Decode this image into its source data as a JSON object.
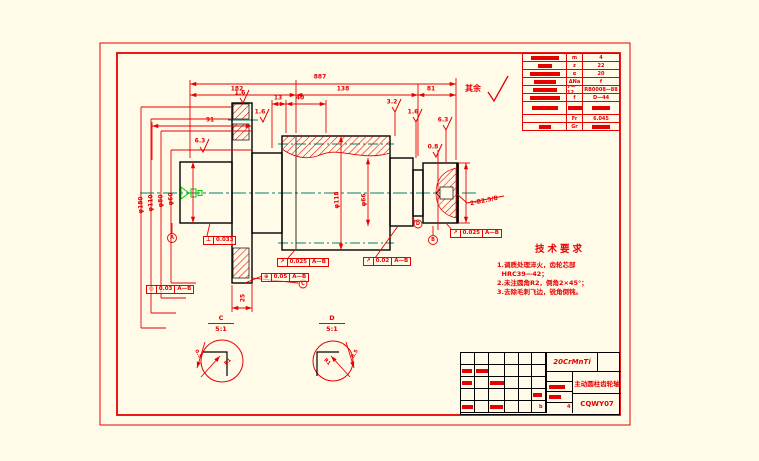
{
  "colors": {
    "background": "#FFFBE8",
    "line_red": "#E60000",
    "line_black": "#000000",
    "centerline_green": "#00806A",
    "symbol_green": "#00CC00"
  },
  "surface_note": {
    "label": "其余"
  },
  "tech_req": {
    "title": "技术要求",
    "lines": [
      "1.调质处理淬火，齿轮芯部",
      "  HRC39—42；",
      "2.未注圆角R2，倒角2×45°；",
      "3.去除毛刺飞边，锐角倒钝。"
    ]
  },
  "param_table": {
    "rows": [
      [
        {
          "b": 28
        },
        {
          "t": "m"
        },
        {
          "t": "4"
        }
      ],
      [
        {
          "b": 14
        },
        {
          "t": "z"
        },
        {
          "t": "22"
        }
      ],
      [
        {
          "b": 30
        },
        {
          "t": "α"
        },
        {
          "t": "20"
        }
      ],
      [
        {
          "b": 22
        },
        {
          "t": "ΔNa"
        },
        {
          "t": "f"
        }
      ],
      [
        {
          "b": 24
        },
        {
          "t": "7—12"
        },
        {
          "t": "RB0008—88"
        }
      ],
      [
        {
          "b": 30
        },
        {
          "t": "f"
        },
        {
          "t": "D—44"
        }
      ],
      [
        {
          "b": 26
        },
        {
          "b": 14
        },
        {
          "b": 18
        }
      ],
      [
        {
          "t": ""
        },
        {
          "t": "Fr"
        },
        {
          "t": "6.045"
        }
      ],
      [
        {
          "b": 12
        },
        {
          "t": "Gr"
        },
        {
          "b": 18
        }
      ]
    ]
  },
  "title_block": {
    "material": "20CrMnTi",
    "part_name": "主动圆柱齿轮轴",
    "drawing_no": "CQWY07",
    "footer_left": "b",
    "footer_right": "4"
  },
  "details": [
    {
      "label": "C",
      "scale": "5:1"
    },
    {
      "label": "D",
      "scale": "5:1"
    }
  ],
  "dim_labels": [
    {
      "name": "dim-overall",
      "x": 320,
      "y": 77,
      "text": "887"
    },
    {
      "name": "dim-182",
      "x": 237,
      "y": 89,
      "text": "182"
    },
    {
      "name": "dim-138",
      "x": 343,
      "y": 89,
      "text": "138"
    },
    {
      "name": "dim-81",
      "x": 431,
      "y": 89,
      "text": "81"
    },
    {
      "name": "dim-13",
      "x": 278,
      "y": 98,
      "text": "13"
    },
    {
      "name": "dim-40",
      "x": 300,
      "y": 98,
      "text": "40"
    },
    {
      "name": "dim-91",
      "x": 210,
      "y": 120,
      "text": "91"
    },
    {
      "name": "dia-flange",
      "x": 141,
      "y": 205,
      "text": "φ180",
      "rot": -90
    },
    {
      "name": "dia-collar",
      "x": 151,
      "y": 203,
      "text": "φ110",
      "rot": -90
    },
    {
      "name": "dia-neck",
      "x": 161,
      "y": 201,
      "text": "φ80",
      "rot": -90
    },
    {
      "name": "dia-stub",
      "x": 171,
      "y": 199,
      "text": "φ60",
      "rot": -90
    },
    {
      "name": "dia-gear",
      "x": 337,
      "y": 200,
      "text": "φ118",
      "rot": -90
    },
    {
      "name": "dia-step",
      "x": 364,
      "y": 200,
      "text": "φ66",
      "rot": -90
    },
    {
      "name": "rough-stub",
      "x": 200,
      "y": 141,
      "text": "6.3"
    },
    {
      "name": "rough-flange",
      "x": 240,
      "y": 93,
      "text": "1.6"
    },
    {
      "name": "rough-neck",
      "x": 260,
      "y": 112,
      "text": "1.6"
    },
    {
      "name": "rough-gear",
      "x": 392,
      "y": 102,
      "text": "3.2"
    },
    {
      "name": "rough-step",
      "x": 413,
      "y": 112,
      "text": "1.6"
    },
    {
      "name": "rough-end",
      "x": 443,
      "y": 120,
      "text": "6.3"
    },
    {
      "name": "rough-face",
      "x": 433,
      "y": 147,
      "text": "0.8"
    },
    {
      "name": "center-hole-note",
      "x": 484,
      "y": 201,
      "text": "2-B2.5/8",
      "rot": -12
    },
    {
      "name": "dim-25",
      "x": 243,
      "y": 298,
      "text": "25",
      "rot": -90
    },
    {
      "name": "detail-c-r1",
      "x": 228,
      "y": 362,
      "text": "R1",
      "rot": -45,
      "size": 5
    },
    {
      "name": "detail-c-05",
      "x": 198,
      "y": 354,
      "text": "0.5",
      "rot": 60,
      "size": 5
    },
    {
      "name": "detail-d-r1",
      "x": 327,
      "y": 362,
      "text": "R1",
      "rot": 45,
      "size": 5
    },
    {
      "name": "detail-d-05",
      "x": 355,
      "y": 354,
      "text": "0.5",
      "rot": -60,
      "size": 5
    },
    {
      "name": "datum-a-letter",
      "x": 172,
      "y": 238,
      "text": "A",
      "size": 5
    },
    {
      "name": "datum-b-letter",
      "x": 433,
      "y": 240,
      "text": "B",
      "size": 5
    },
    {
      "name": "detail-marker-c",
      "x": 303,
      "y": 284,
      "text": "C",
      "size": 5
    },
    {
      "name": "detail-marker-d",
      "x": 418,
      "y": 224,
      "text": "D",
      "size": 5
    }
  ],
  "tolerance_frames": [
    {
      "x": 203,
      "y": 236,
      "sym": "⊥",
      "val": "0.033",
      "datum": ""
    },
    {
      "x": 146,
      "y": 285,
      "sym": "◎",
      "val": "0.03",
      "datum": "A—B"
    },
    {
      "x": 277,
      "y": 258,
      "sym": "↗",
      "val": "0.025",
      "datum": "A—B"
    },
    {
      "x": 261,
      "y": 273,
      "sym": "⊕",
      "val": "0.05",
      "datum": "A—B"
    },
    {
      "x": 363,
      "y": 257,
      "sym": "↗",
      "val": "0.02",
      "datum": "A—B"
    },
    {
      "x": 450,
      "y": 229,
      "sym": "↗",
      "val": "0.025",
      "datum": "A—B"
    }
  ]
}
